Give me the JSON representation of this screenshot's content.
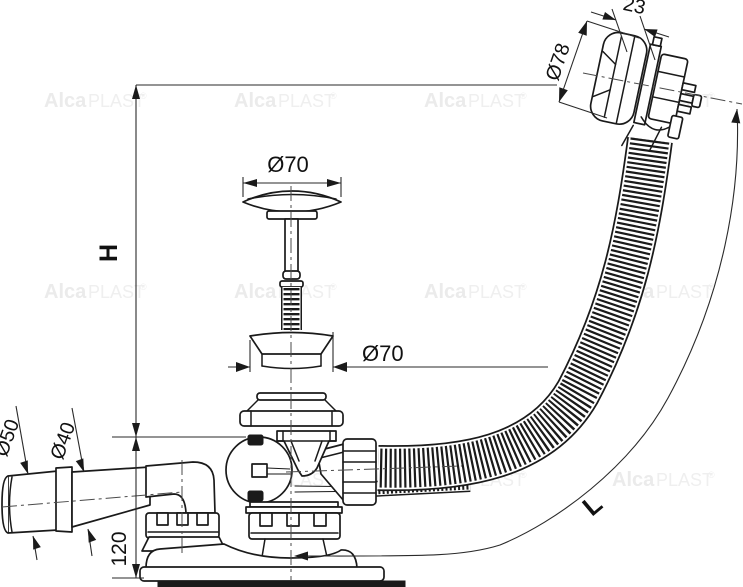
{
  "watermark": {
    "brand_bold": "Alca",
    "brand_light": "PLAST",
    "registered": "®"
  },
  "dimensions": {
    "overall_height": "H",
    "base_height": "120",
    "plug_cap_diameter": "Ø70",
    "waste_flange_diameter": "Ø70",
    "overflow_knob_diameter": "Ø78",
    "overflow_knob_depth": "23",
    "outlet_outer_diameter": "Ø50",
    "outlet_inner_diameter": "Ø40",
    "hose_length": "L"
  },
  "colors": {
    "line": "#1a1a1a",
    "dimension": "#2a2a2a",
    "centerline": "#4a4a4a",
    "watermark": "#ebebeb",
    "background": "#ffffff"
  }
}
